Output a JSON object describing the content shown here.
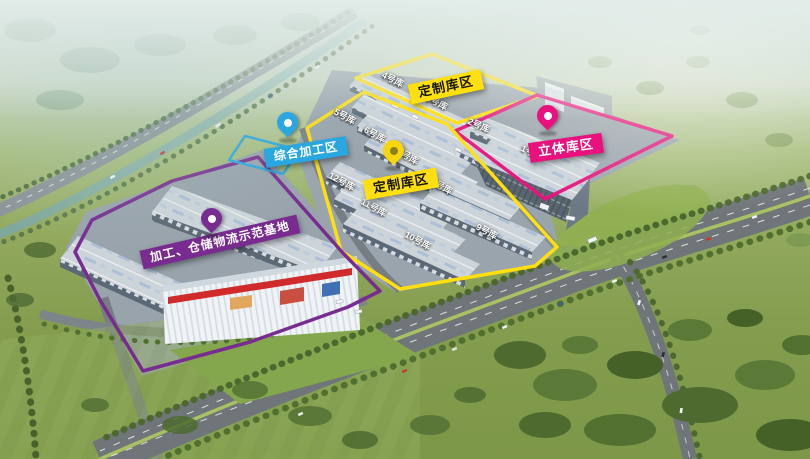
{
  "zones": {
    "custom_north": {
      "label": "定制库区",
      "color": "#ffdf0e",
      "text_color": "#161616"
    },
    "custom_main": {
      "label": "定制库区",
      "color": "#ffdf0e",
      "text_color": "#161616",
      "pin": "yellow-map-pin",
      "pin_color": "#f6d70e"
    },
    "stereo": {
      "label": "立体库区",
      "color": "#e8117d",
      "text_color": "#ffffff",
      "pin": "magenta-map-pin",
      "pin_color": "#e8117d"
    },
    "processing": {
      "label": "综合加工区",
      "color": "#2aa7e0",
      "text_color": "#ffffff",
      "pin": "blue-map-pin",
      "pin_color": "#2aa7e0"
    },
    "base": {
      "label": "加工、仓储物流示范基地",
      "color": "#792c90",
      "text_color": "#ffffff",
      "pin": "purple-map-pin",
      "pin_color": "#792c90"
    }
  },
  "buildings": [
    {
      "id": "b1",
      "label": "1号库"
    },
    {
      "id": "b2",
      "label": "2号库"
    },
    {
      "id": "b3",
      "label": "3号库"
    },
    {
      "id": "b4",
      "label": "4号库"
    },
    {
      "id": "b5",
      "label": "5号库"
    },
    {
      "id": "b6",
      "label": "6号库"
    },
    {
      "id": "b7",
      "label": "7号库"
    },
    {
      "id": "b8",
      "label": "8号库"
    },
    {
      "id": "b9",
      "label": "9号库"
    },
    {
      "id": "b10",
      "label": "10号库"
    },
    {
      "id": "b11",
      "label": "11号库"
    },
    {
      "id": "b12",
      "label": "12号库"
    }
  ]
}
